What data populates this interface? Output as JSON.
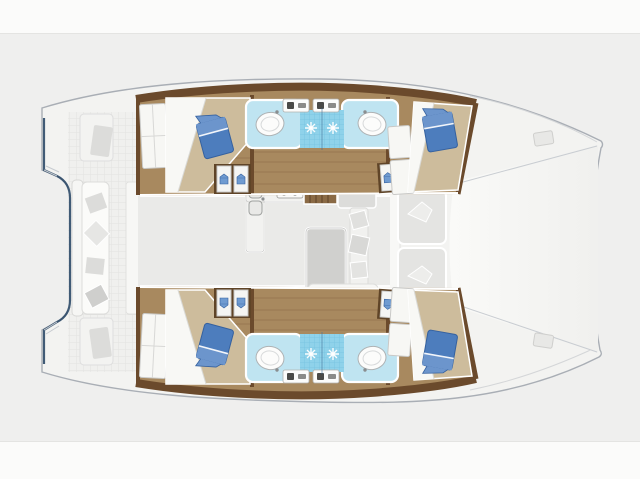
{
  "image": {
    "title": "Catamaran yacht interior layout plan (top view)",
    "type": "deck-plan-illustration",
    "orientation": "bows pointing right, stern with cockpit at left"
  },
  "palette": {
    "bg-white": "#fbfbfa",
    "bg-gray": "#efefee",
    "band-line": "#e4e4e2",
    "hull-fill": "#f3f3f1",
    "hull-line": "#a9aeb5",
    "transom-line": "#2e4a68",
    "deck-a": "#f0f0ee",
    "deck-grid": "#e2e2e0",
    "wood-floor": "#a8895f",
    "wood-plank": "#8a6a45",
    "wood-dark": "#6b4a2c",
    "stair-wood": "#8a6a45",
    "bed-cover": "#cdbc9c",
    "linen-white": "#f8f8f5",
    "pillow-blue": "#4d7dbd",
    "pillow-blue-light": "#6c95cc",
    "pillow-blue-dark": "#35619f",
    "counter-blue": "#bfe4f1",
    "shower-blue": "#8fd2ea",
    "shower-tile": "#6fbfdd",
    "fixture-white": "#fcfcfb",
    "saloon-floor": "#eaeae8",
    "furniture-gray": "#dcdcda",
    "furniture-light": "#e4e4e2",
    "table-gray": "#d0d0ce"
  },
  "rooms": {
    "boat": "Catamaran deck plan, bird's eye view",
    "aft_cockpit": "Aft cockpit with teak floor",
    "transom_bench": "Aft transom bench with cushions",
    "helm_seat": "Cockpit side seat",
    "swim_step_port": "Port transom step",
    "swim_step_starboard": "Starboard transom step",
    "saloon": "Saloon on bridge deck",
    "galley": "Galley with double sink and stove",
    "stove": "Four burner stove",
    "galley_sink": "Galley double sink",
    "dinette_table": "Saloon dinette table",
    "saloon_sofa": "Saloon sofa with cushions",
    "stairs_port": "Companionway stairs to port hull",
    "stairs_starboard": "Companionway stairs to starboard hull",
    "hull_port": "Port hull (top) with two cabins and two shower rooms",
    "hull_starboard": "Starboard hull (bottom) with two cabins and two shower rooms",
    "aft_cabin": "Aft double cabin with berth and blue cushion",
    "fwd_cabin": "Forward double cabin with berth and blue cushion",
    "bed": "Double berth with white linen and beige cover",
    "blue_cushion": "Blue deco cushion",
    "wardrobe": "Wardrobe / hanging locker with clothes",
    "head_aft": "Aft head: washbasin and shower",
    "head_fwd": "Forward head: washbasin and shower",
    "washbasin": "Round washbasin on light blue counter",
    "shower": "Shower floor with sparkling tiles",
    "toilet": "Marine toilet fixture",
    "fwd_cockpit": "Forward cockpit bench seats",
    "foredeck": "Foredeck / trampoline area between the bows",
    "bow_port": "Port bow",
    "bow_starboard": "Starboard bow",
    "deck_hatch": "Deck hatch"
  },
  "visible_features": {
    "cabins": 4,
    "double_berths": 4,
    "washbasins": 4,
    "showers": 4,
    "blue_cushions": 4,
    "hulls": 2,
    "saloon_tables": 1,
    "stair_flights": 2
  }
}
